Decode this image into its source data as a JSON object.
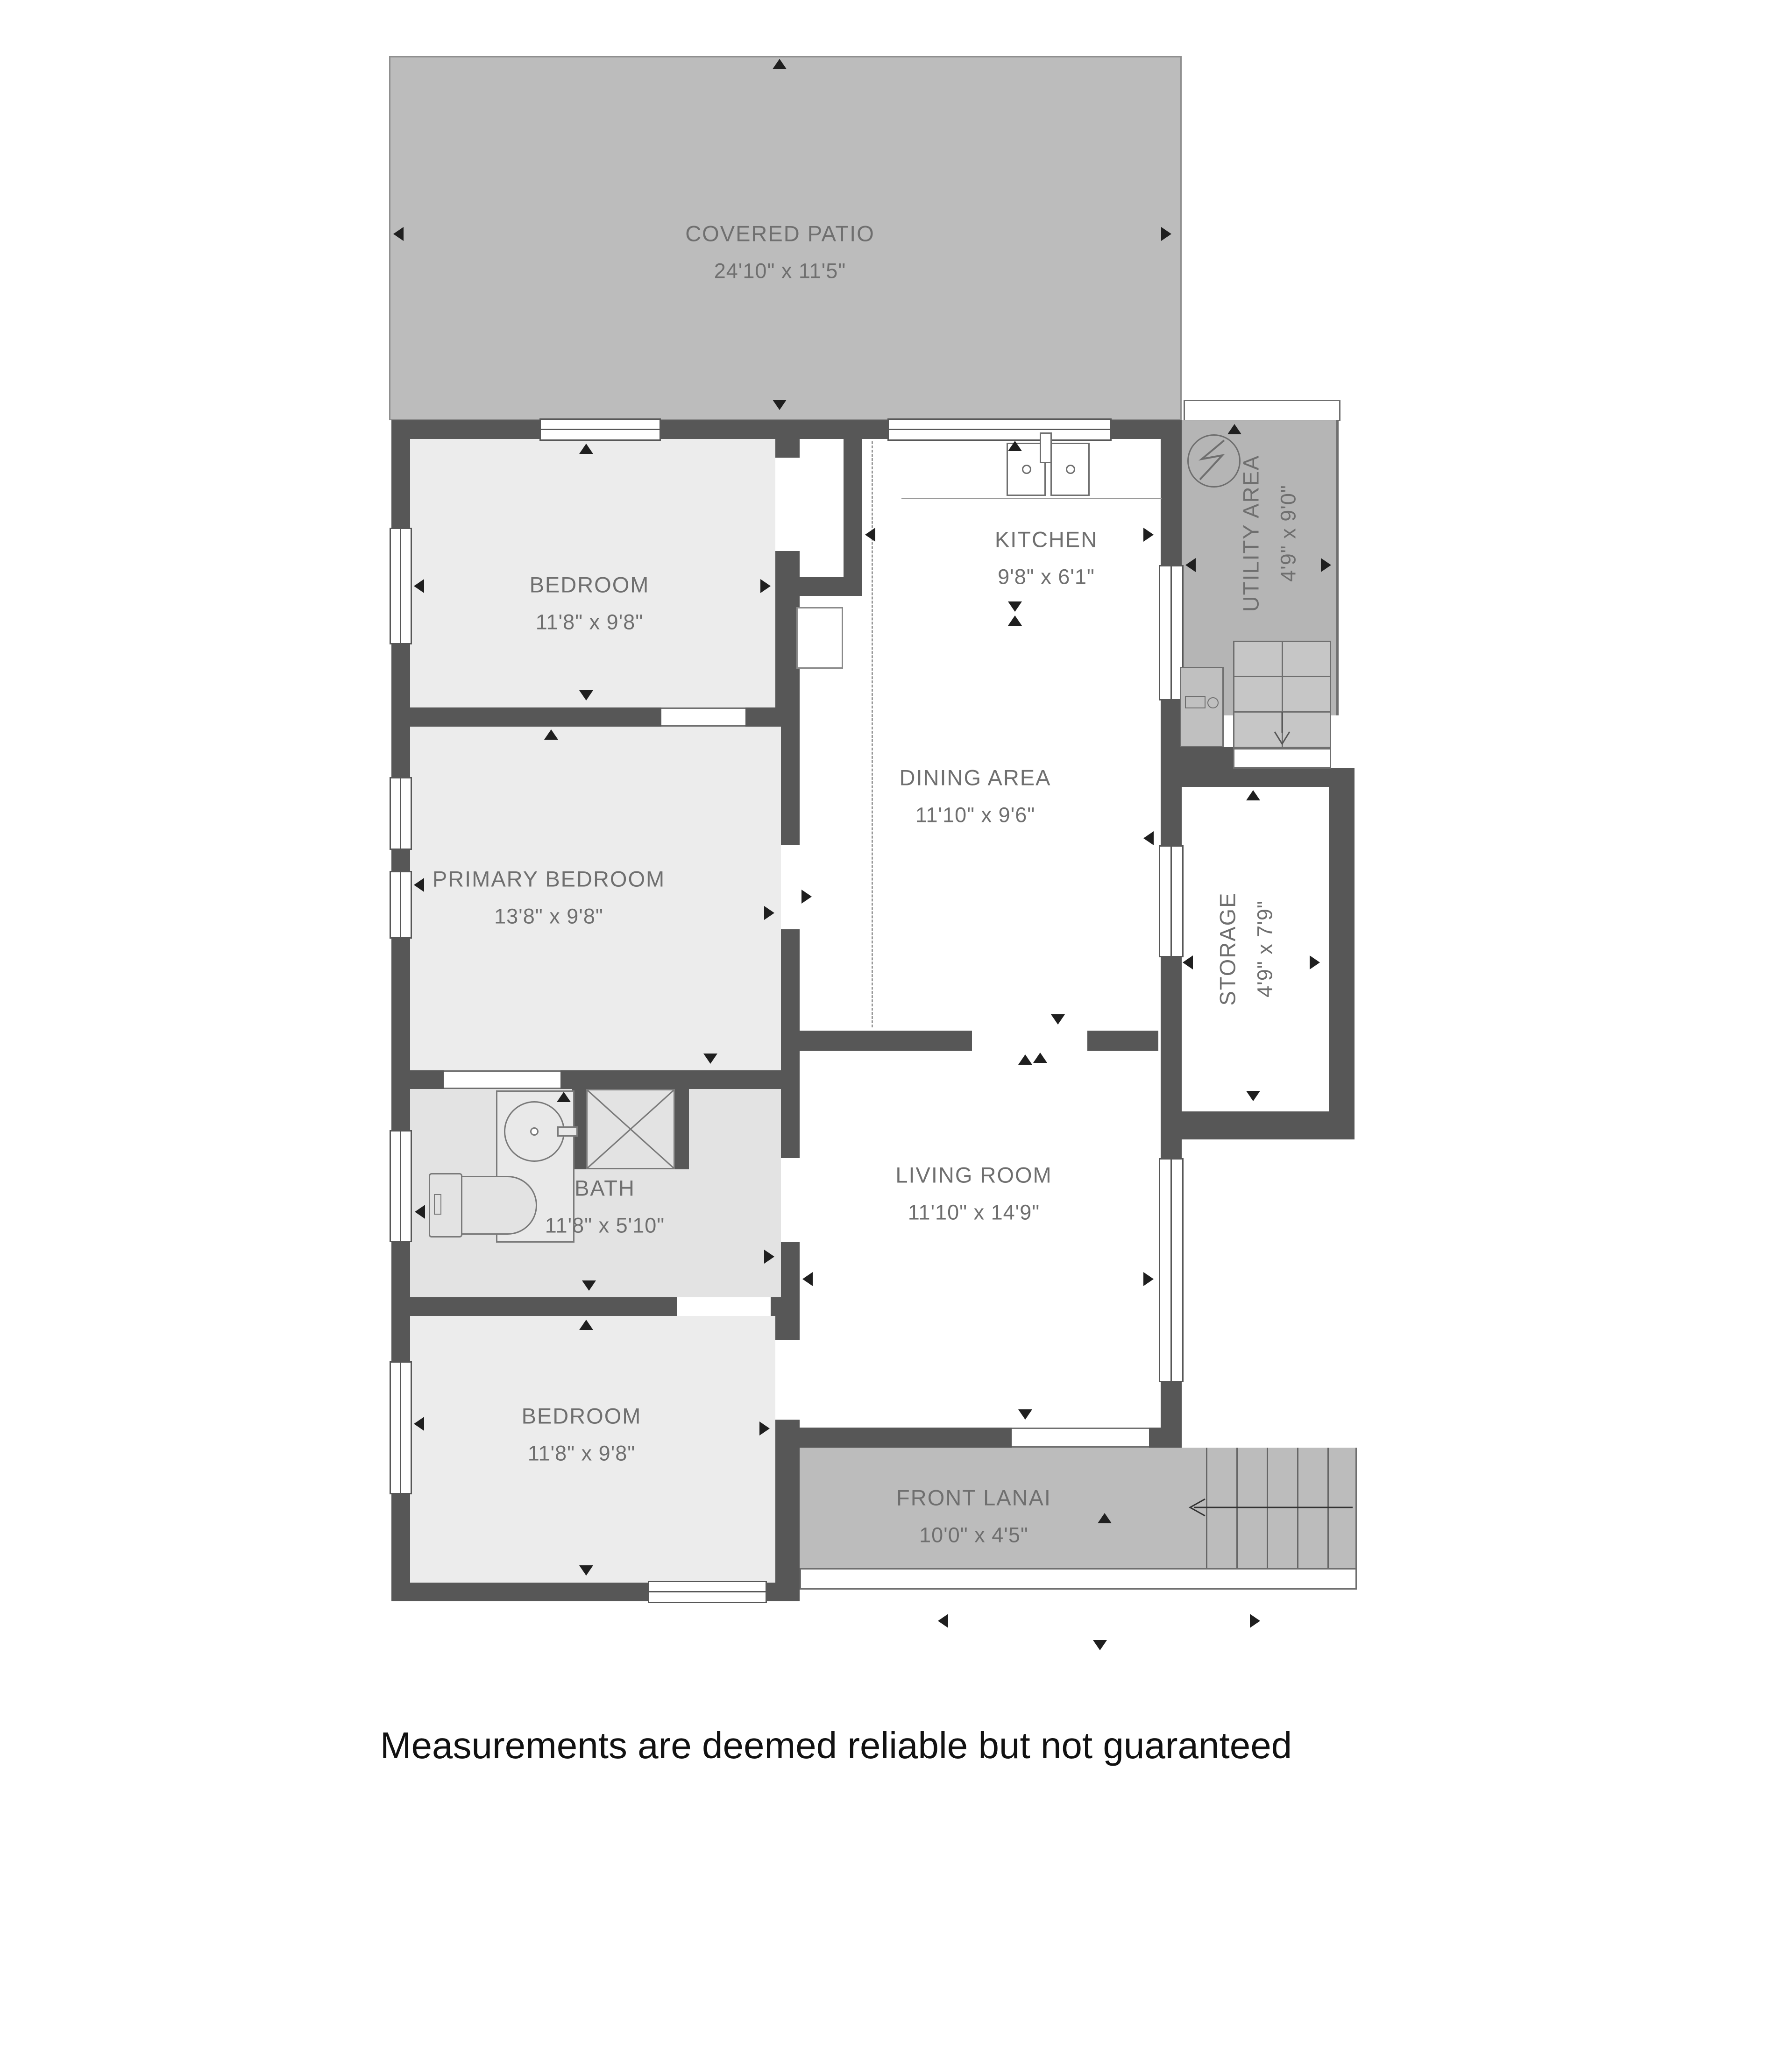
{
  "title": "Floor plan",
  "disclaimer": "Measurements are deemed reliable but not guaranteed",
  "rooms": {
    "covered_patio": {
      "name": "COVERED PATIO",
      "dims": "24'10\" x 11'5\""
    },
    "bedroom_top": {
      "name": "BEDROOM",
      "dims": "11'8\" x 9'8\""
    },
    "kitchen": {
      "name": "KITCHEN",
      "dims": "9'8\" x 6'1\""
    },
    "utility": {
      "name": "UTILITY AREA",
      "dims": "4'9\" x 9'0\""
    },
    "dining": {
      "name": "DINING AREA",
      "dims": "11'10\" x 9'6\""
    },
    "storage": {
      "name": "STORAGE",
      "dims": "4'9\" x 7'9\""
    },
    "primary": {
      "name": "PRIMARY BEDROOM",
      "dims": "13'8\" x 9'8\""
    },
    "bath": {
      "name": "BATH",
      "dims": "11'8\" x 5'10\""
    },
    "living": {
      "name": "LIVING ROOM",
      "dims": "11'10\" x 14'9\""
    },
    "bedroom_bottom": {
      "name": "BEDROOM",
      "dims": "11'8\" x 9'8\""
    },
    "front_lanai": {
      "name": "FRONT LANAI",
      "dims": "10'0\" x 4'5\""
    }
  },
  "icons": [
    "water-heater-icon",
    "washing-machine-icon",
    "stairs-down-icon",
    "stairs-entry-icon",
    "kitchen-sink-icon",
    "bath-sink-icon",
    "shower-icon",
    "toilet-icon",
    "dimension-tick-icon"
  ],
  "colors": {
    "wall": "#575757",
    "patio": "#bcbcbc",
    "utility": "#b5b5b5",
    "bedroom": "#ececec",
    "bath": "#e3e3e3",
    "label": "#6f6f6f",
    "disclaimer": "#111111",
    "background": "#ffffff"
  }
}
